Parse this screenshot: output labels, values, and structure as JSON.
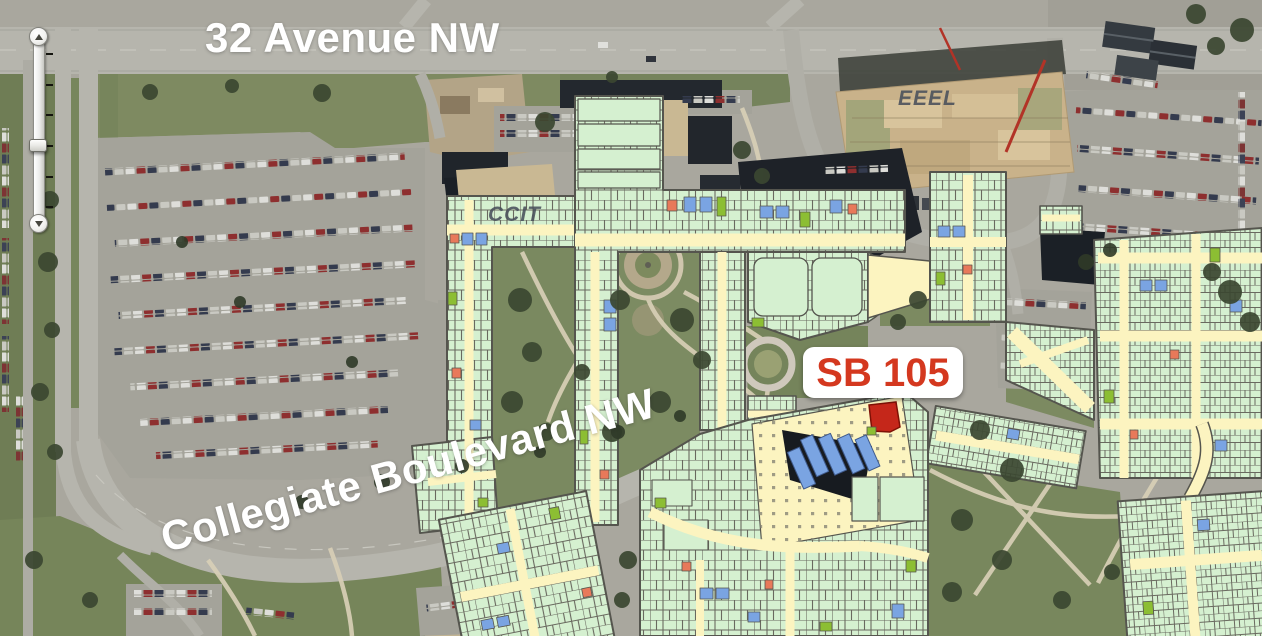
{
  "map": {
    "street_labels": [
      {
        "id": "32-avenue-nw",
        "text": "32 Avenue NW"
      },
      {
        "id": "collegiate-boulevard-nw",
        "text": "Collegiate Boulevard NW"
      }
    ],
    "building_labels": [
      {
        "id": "ccit",
        "text": "CCIT"
      },
      {
        "id": "eeel",
        "text": "EEEL"
      }
    ],
    "room_marker": {
      "label": "SB 105"
    },
    "palette": {
      "mapped_building_fill": "#d5f0d0",
      "corridor_fill": "#fcf4c0",
      "room_outline": "#55554e",
      "stair_room_blue": "#7aa4e2",
      "special_room_olive": "#8cbe33",
      "special_room_salmon": "#e8795a",
      "highlight_room_red": "#c5271a",
      "marker_text_red": "#d4381f",
      "street_label_white": "#ffffff",
      "building_label_gray": "#565b63",
      "unmapped_roof_dark": "#20252b",
      "construction_site_tan": "#c9b28a",
      "road_gray": "#b6b5ad",
      "grass_green": "#7b8a60"
    }
  },
  "zoom_control": {
    "tick_count": 6
  }
}
